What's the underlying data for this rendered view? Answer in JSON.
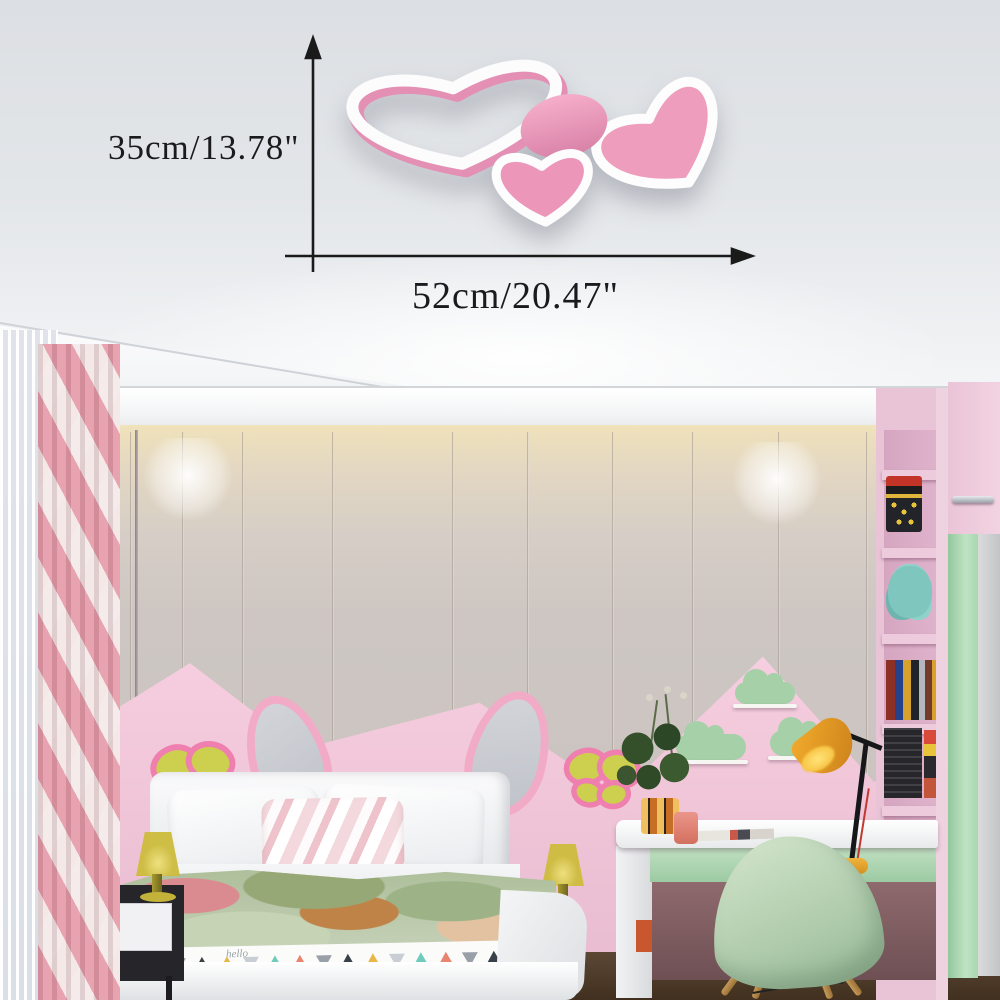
{
  "annotation": {
    "height_label": "35cm/13.78\"",
    "width_label": "52cm/20.47\"",
    "arrow_color": "#1a1a1a"
  },
  "lamp": {
    "type": "heart-shaped ceiling lamp",
    "parts": [
      "open-heart-ring",
      "filled-heart-large",
      "filled-heart-small",
      "round-disc"
    ],
    "pink": "#ef9fbf",
    "pink_deep": "#e390b4",
    "border_white": "#ffffff"
  },
  "bed": {
    "duvet_script": "hello",
    "triangle_colors": [
      "#6fccbc",
      "#e88570",
      "#9aa0a8",
      "#394049",
      "#e8b74a",
      "#c9ced4"
    ]
  },
  "scene": {
    "wall_gray": "#cdc6c2",
    "panel_pink": "#f2c9da",
    "mint_green": "#a5d0a8",
    "butterfly_yellow": "#cdd04e",
    "butterfly_outline": "#ef7fae",
    "curtain_pink": "#e49aa7",
    "floor_brown": "#4a3a2c",
    "desk_lamp_yellow": "#f2ab2c",
    "chair_mint": "#b9d4b2",
    "objects": [
      "sheer-curtain",
      "chevron-curtain",
      "panel-wall",
      "spotlights",
      "butterfly-decor-left",
      "butterfly-decor-right",
      "bunny-ear-headboard",
      "bed",
      "nightstand",
      "bedside-lamp-left",
      "bedside-lamp-right",
      "cloud-shelves",
      "desk",
      "desk-lamp",
      "plant",
      "cup",
      "chair",
      "bookshelf",
      "wardrobe"
    ]
  }
}
